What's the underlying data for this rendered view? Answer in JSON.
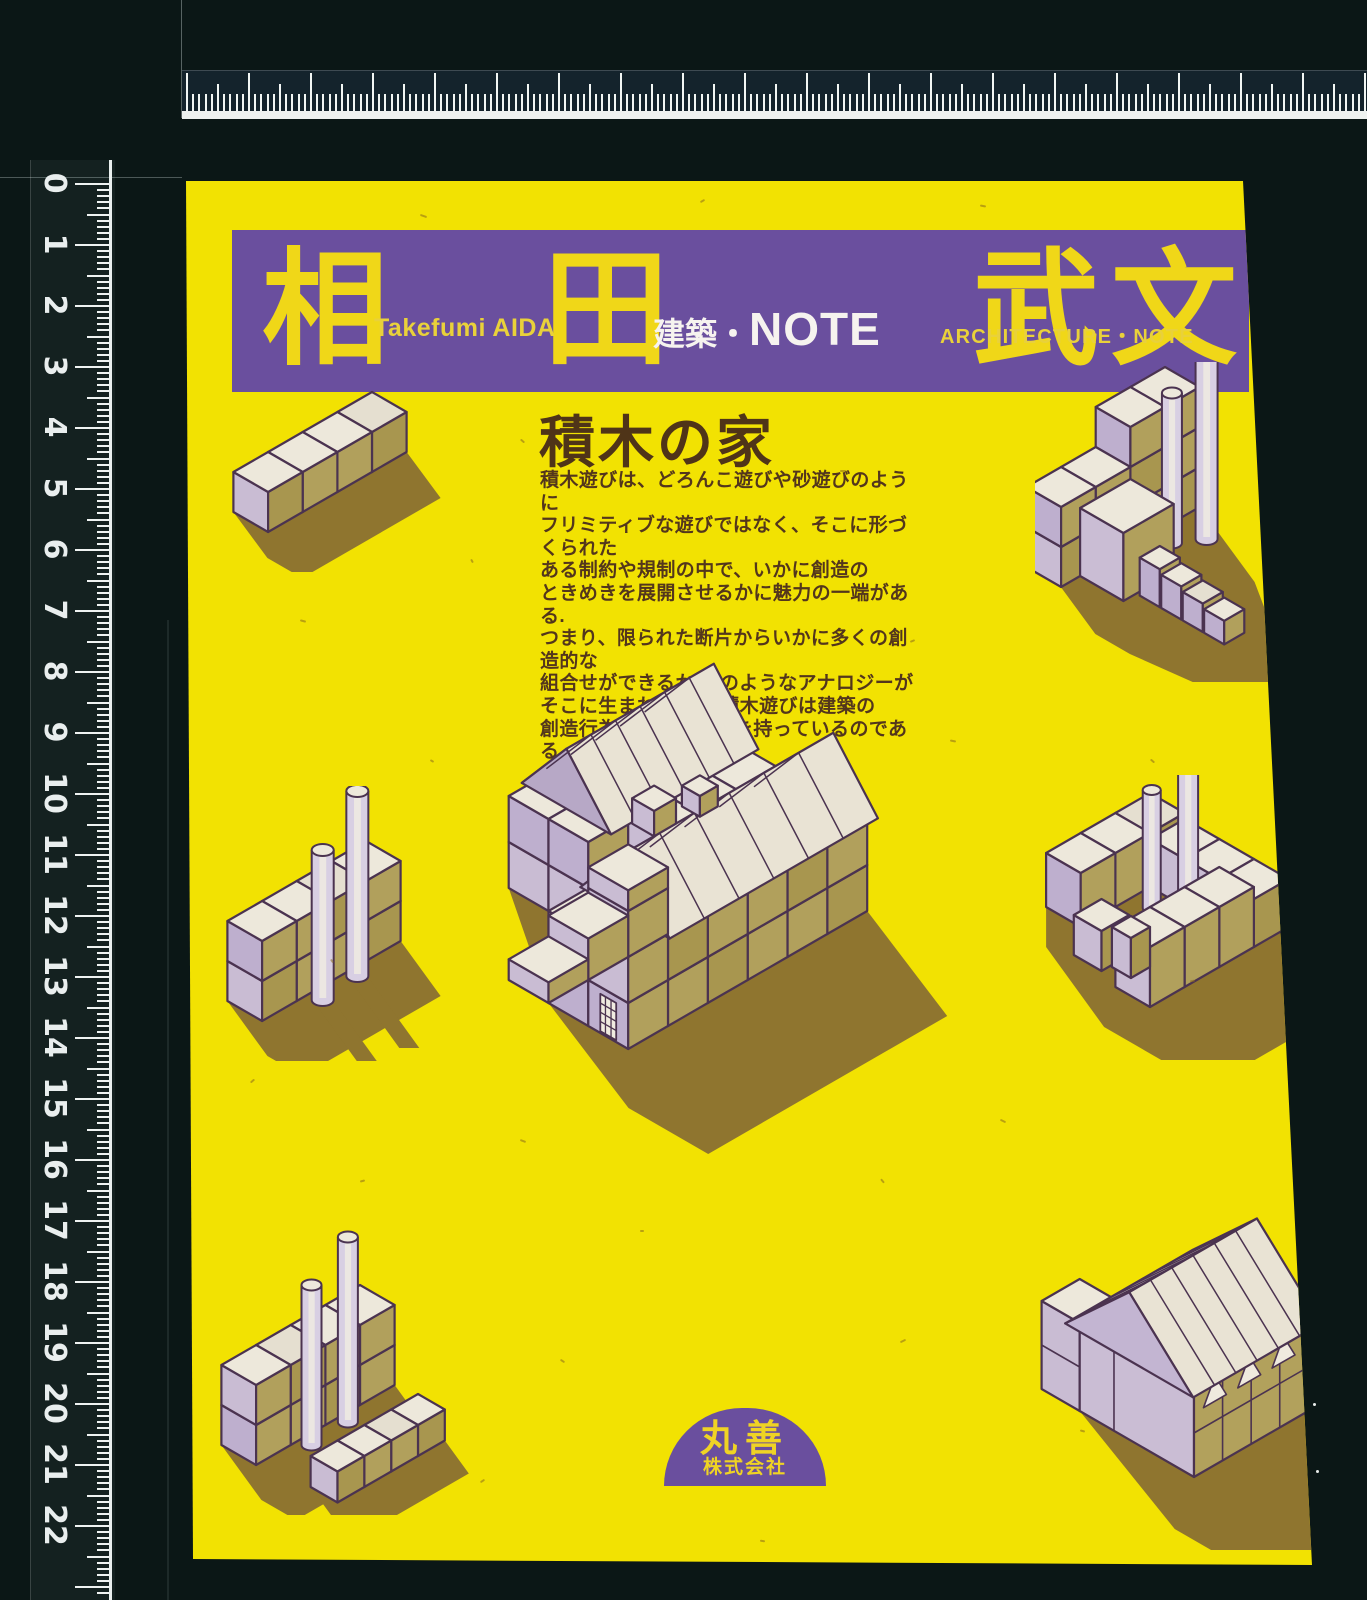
{
  "scan": {
    "left_ruler": {
      "numbers": [
        "0",
        "1",
        "2",
        "3",
        "4",
        "5",
        "6",
        "7",
        "8",
        "9",
        "10",
        "11",
        "12",
        "13",
        "14",
        "15",
        "16",
        "17",
        "18",
        "19",
        "20",
        "21",
        "22"
      ]
    }
  },
  "cover": {
    "banner": {
      "kanji": [
        "相",
        "田",
        "武",
        "文"
      ],
      "author_latin": "Takefumi AIDA",
      "series_jp_prefix": "建築・",
      "series_jp_note": "NOTE",
      "series_en": "ARCHITECTURE・NOTE"
    },
    "title": "積木の家",
    "body_lines": [
      "積木遊びは、どろんこ遊びや砂遊びのように",
      "フリミティブな遊びではなく、そこに形づくられた",
      "ある制約や規制の中で、いかに創造の",
      "ときめきを展開させるかに魅力の一端がある.",
      "つまり、限られた断片からいかに多くの創造的な",
      "組合せができるか.どのようなアナロジーが",
      "そこに生まれるか.　積木遊びは建築の",
      "創造行為と深い関係性を持っているのである."
    ],
    "publisher": {
      "name": "丸善",
      "suffix": "株式会社"
    },
    "illustrations": [
      "row-of-four-blocks",
      "c-shaped-blocks-with-cylinders",
      "block-wall-with-two-cylinders",
      "block-courtyard-with-cylinders",
      "block-wall-with-cylinders-and-row",
      "large-block-house",
      "block-house-with-gabled-roof"
    ]
  },
  "colors": {
    "cover_yellow": "#f2e202",
    "banner_purple": "#6a4f9e",
    "banner_kanji_yellow": "#f0d718",
    "banner_latin_yellow": "#e9d13a",
    "banner_white": "#f6f3ef",
    "title_brown": "#4f3418",
    "body_brown": "#53361c",
    "block_top": "#ede8db",
    "block_top_alt": "#e5dfd0",
    "block_right": "#b1a05c",
    "block_right_alt": "#a8964f",
    "block_left": "#c9bcd3",
    "block_left_alt": "#beafce",
    "block_line": "#4b3350",
    "roof_light": "#f2eee3",
    "roof_shade": "#e9e3d4",
    "gable_lavender": "#b7a8c6",
    "cylinder_body": "#d8cfe3",
    "shadow_olive": "#8f752f",
    "ruler_white": "#e9eeee",
    "background_black": "#0b1716"
  }
}
